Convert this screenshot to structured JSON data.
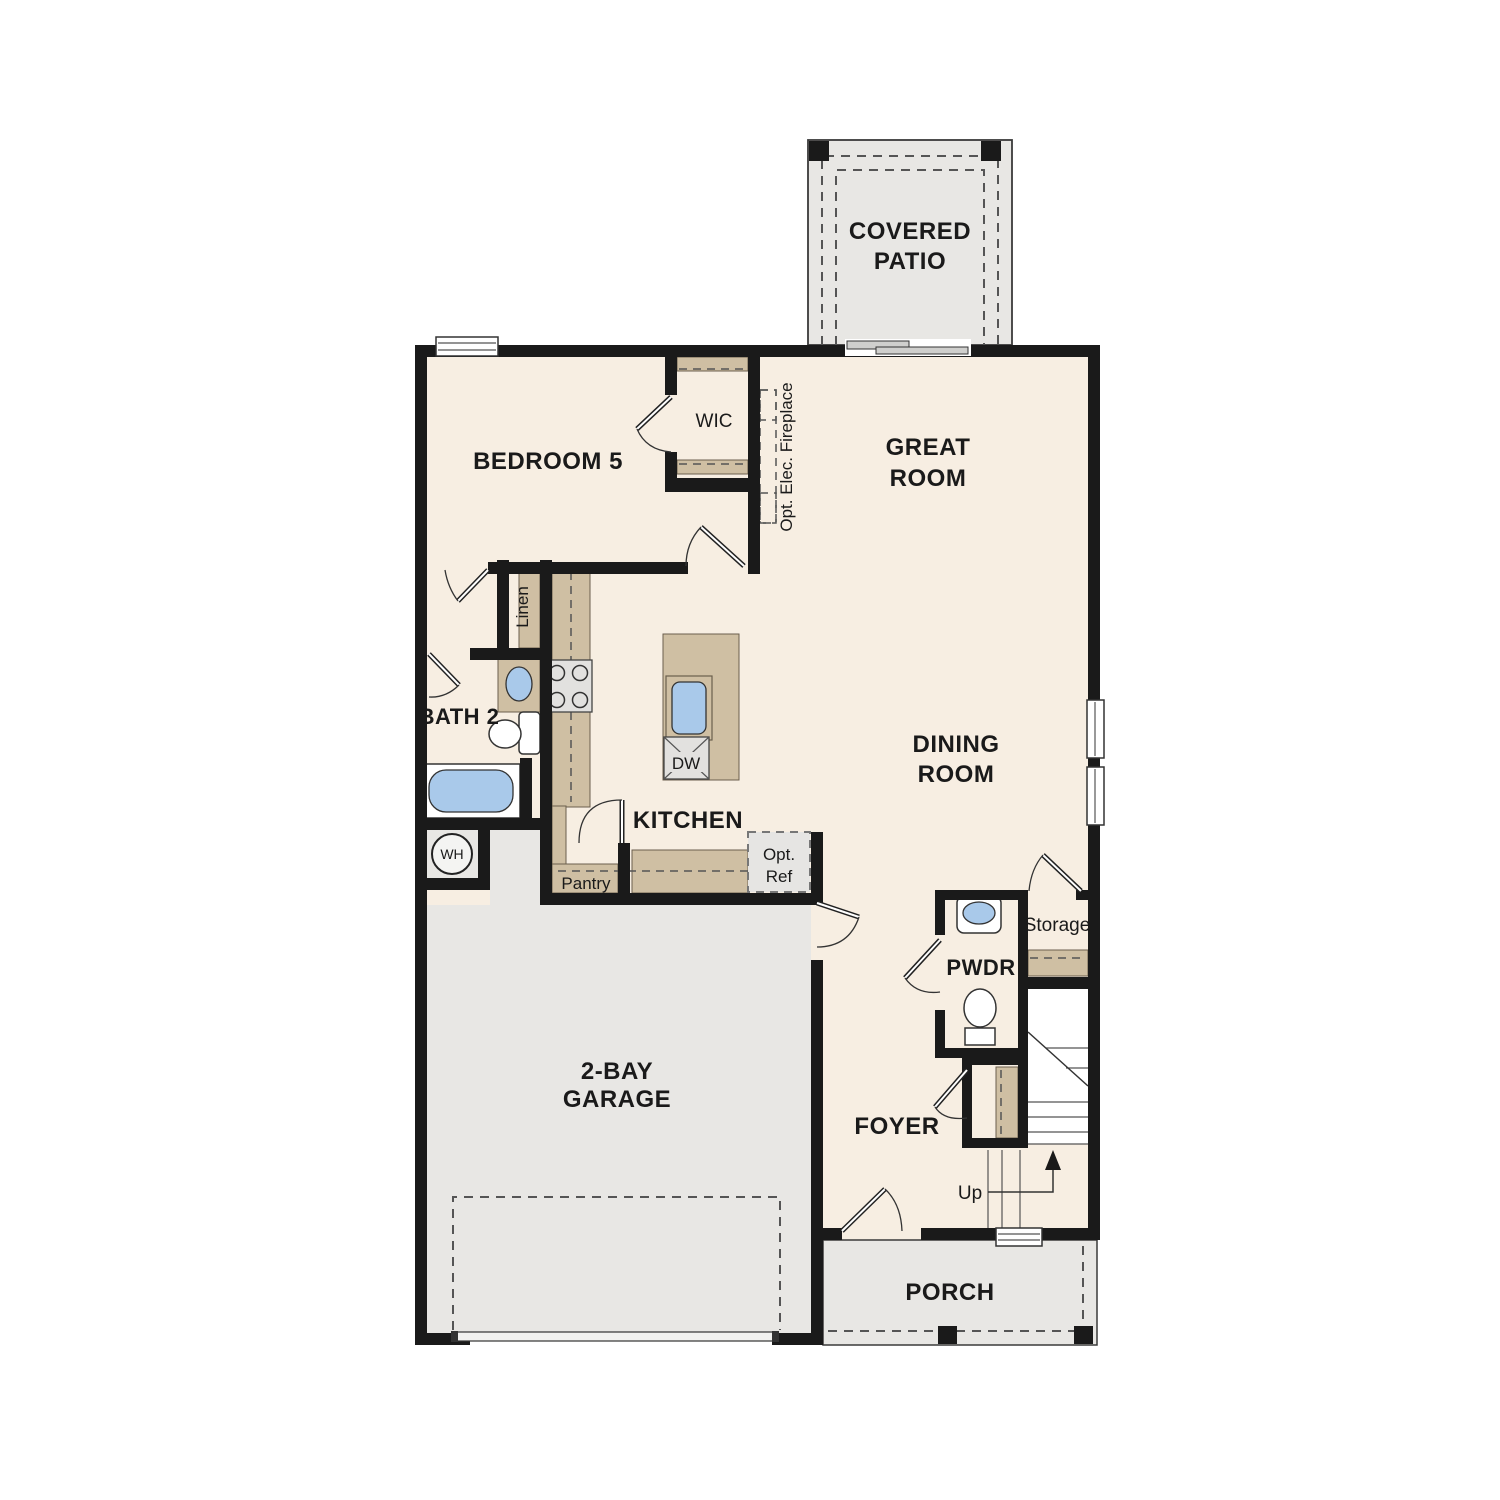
{
  "title": "First Floor Plan",
  "colors": {
    "wall": "#1a1a1a",
    "floor": "#f7eee2",
    "exterior": "#e8e7e4",
    "counter": "#cfbfa3",
    "counter_edge": "#6b5f4d",
    "water": "#a9c9ea",
    "fixture": "#ffffff",
    "appliance": "#e2e1df",
    "dash": "#555555",
    "ink": "#1a1a1a"
  },
  "rooms": {
    "covered_patio": {
      "label": [
        "COVERED",
        "PATIO"
      ]
    },
    "bedroom5": {
      "label": "BEDROOM 5"
    },
    "wic": {
      "label": "WIC"
    },
    "great_room": {
      "label": [
        "GREAT",
        "ROOM"
      ]
    },
    "dining_room": {
      "label": [
        "DINING",
        "ROOM"
      ]
    },
    "kitchen": {
      "label": "KITCHEN"
    },
    "bath2": {
      "label": "BATH 2"
    },
    "linen": {
      "label": "Linen"
    },
    "pantry": {
      "label": "Pantry"
    },
    "garage": {
      "label": [
        "2-BAY",
        "GARAGE"
      ]
    },
    "pwdr": {
      "label": "PWDR"
    },
    "storage": {
      "label": "Storage"
    },
    "foyer": {
      "label": "FOYER"
    },
    "porch": {
      "label": "PORCH"
    }
  },
  "annotations": {
    "fireplace": "Opt. Elec. Fireplace",
    "opt_ref": [
      "Opt.",
      "Ref"
    ],
    "dishwasher": "DW",
    "water_heater": "WH",
    "stairs_up": "Up"
  }
}
